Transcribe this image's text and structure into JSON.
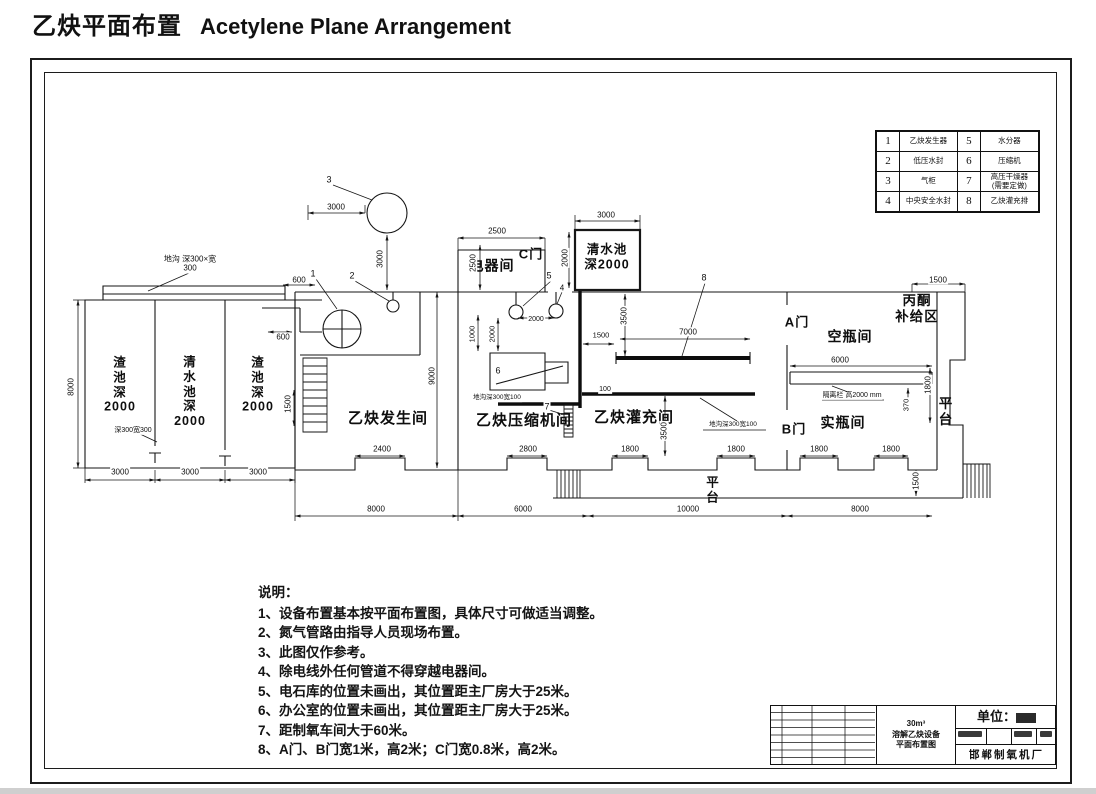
{
  "header": {
    "title_zh": "乙炔平面布置",
    "title_en": "Acetylene Plane Arrangement"
  },
  "legend": {
    "rows": [
      {
        "n1": "1",
        "l1": "乙炔发生器",
        "n2": "5",
        "l2": "水分器"
      },
      {
        "n1": "2",
        "l1": "低压水封",
        "n2": "6",
        "l2": "压缩机"
      },
      {
        "n1": "3",
        "l1": "气柜",
        "n2": "7",
        "l2": "高压干燥器\n(需要定做)"
      },
      {
        "n1": "4",
        "l1": "中央安全水封",
        "n2": "8",
        "l2": "乙炔灌充排"
      }
    ]
  },
  "drawing": {
    "labels": [
      {
        "t": "乙炔发生间",
        "x": 388,
        "y": 419,
        "s": 15,
        "b": 1
      },
      {
        "t": "乙炔压缩机间",
        "x": 524,
        "y": 421,
        "s": 15,
        "b": 1
      },
      {
        "t": "乙炔灌充间",
        "x": 634,
        "y": 418,
        "s": 15,
        "b": 1
      },
      {
        "t": "电器间",
        "x": 492,
        "y": 266,
        "s": 14,
        "b": 1
      },
      {
        "t": "C门",
        "x": 531,
        "y": 254,
        "s": 13,
        "b": 1
      },
      {
        "t": "清水池\n深2000",
        "x": 607,
        "y": 257,
        "s": 12.5,
        "b": 1
      },
      {
        "t": "A门",
        "x": 797,
        "y": 322,
        "s": 13,
        "b": 1
      },
      {
        "t": "B门",
        "x": 794,
        "y": 429,
        "s": 13,
        "b": 1
      },
      {
        "t": "空瓶间",
        "x": 850,
        "y": 337,
        "s": 14,
        "b": 1
      },
      {
        "t": "实瓶间",
        "x": 843,
        "y": 423,
        "s": 14,
        "b": 1
      },
      {
        "t": "丙酮\n补给区",
        "x": 917,
        "y": 309,
        "s": 13.5,
        "b": 1
      },
      {
        "t": "平\n台",
        "x": 946,
        "y": 412,
        "s": 13.5,
        "b": 1
      },
      {
        "t": "平\n台",
        "x": 713,
        "y": 490,
        "s": 12.5,
        "b": 1
      },
      {
        "t": "渣\n池\n深\n2000",
        "x": 120,
        "y": 385,
        "s": 12.5,
        "b": 1
      },
      {
        "t": "清\n水\n池\n深\n2000",
        "x": 190,
        "y": 392,
        "s": 12.5,
        "b": 1
      },
      {
        "t": "渣\n池\n深\n2000",
        "x": 258,
        "y": 385,
        "s": 12.5,
        "b": 1
      },
      {
        "t": "地沟 深300×宽\n300",
        "x": 190,
        "y": 264,
        "s": 8
      },
      {
        "t": "深300宽300",
        "x": 133,
        "y": 431,
        "s": 7
      },
      {
        "t": "3000",
        "x": 336,
        "y": 207,
        "s": 8
      },
      {
        "t": "3000",
        "x": 380,
        "y": 259,
        "s": 8,
        "r": 1
      },
      {
        "t": "600",
        "x": 299,
        "y": 280,
        "s": 8
      },
      {
        "t": "600",
        "x": 283,
        "y": 337,
        "s": 8
      },
      {
        "t": "1500",
        "x": 288,
        "y": 404,
        "s": 8,
        "r": 1
      },
      {
        "t": "8000",
        "x": 71,
        "y": 387,
        "s": 8,
        "r": 1
      },
      {
        "t": "3000",
        "x": 120,
        "y": 472,
        "s": 8
      },
      {
        "t": "3000",
        "x": 190,
        "y": 472,
        "s": 8
      },
      {
        "t": "3000",
        "x": 258,
        "y": 472,
        "s": 8
      },
      {
        "t": "9000",
        "x": 432,
        "y": 376,
        "s": 8,
        "r": 1
      },
      {
        "t": "2500",
        "x": 497,
        "y": 231,
        "s": 8
      },
      {
        "t": "2500",
        "x": 473,
        "y": 263,
        "s": 8,
        "r": 1
      },
      {
        "t": "3000",
        "x": 606,
        "y": 215,
        "s": 8
      },
      {
        "t": "2000",
        "x": 565,
        "y": 258,
        "s": 8,
        "r": 1
      },
      {
        "t": "2000",
        "x": 536,
        "y": 320,
        "s": 7
      },
      {
        "t": "1000",
        "x": 473,
        "y": 334,
        "s": 7.5,
        "r": 1
      },
      {
        "t": "2000",
        "x": 493,
        "y": 334,
        "s": 7.5,
        "r": 1
      },
      {
        "t": "地沟深300宽100",
        "x": 497,
        "y": 398,
        "s": 6.5
      },
      {
        "t": "1500",
        "x": 601,
        "y": 336,
        "s": 7.5
      },
      {
        "t": "100",
        "x": 605,
        "y": 390,
        "s": 7
      },
      {
        "t": "3500",
        "x": 624,
        "y": 316,
        "s": 8,
        "r": 1
      },
      {
        "t": "7000",
        "x": 688,
        "y": 332,
        "s": 8
      },
      {
        "t": "3500",
        "x": 664,
        "y": 431,
        "s": 8,
        "r": 1
      },
      {
        "t": "地沟深300宽100",
        "x": 733,
        "y": 425,
        "s": 6.5
      },
      {
        "t": "2400",
        "x": 382,
        "y": 449,
        "s": 8
      },
      {
        "t": "2800",
        "x": 528,
        "y": 449,
        "s": 8
      },
      {
        "t": "1800",
        "x": 630,
        "y": 449,
        "s": 8
      },
      {
        "t": "1800",
        "x": 736,
        "y": 449,
        "s": 8
      },
      {
        "t": "1800",
        "x": 819,
        "y": 449,
        "s": 8
      },
      {
        "t": "1800",
        "x": 891,
        "y": 449,
        "s": 8
      },
      {
        "t": "8000",
        "x": 376,
        "y": 509,
        "s": 8
      },
      {
        "t": "6000",
        "x": 523,
        "y": 509,
        "s": 8
      },
      {
        "t": "10000",
        "x": 688,
        "y": 509,
        "s": 8
      },
      {
        "t": "8000",
        "x": 860,
        "y": 509,
        "s": 8
      },
      {
        "t": "1500",
        "x": 916,
        "y": 481,
        "s": 8,
        "r": 1
      },
      {
        "t": "6000",
        "x": 840,
        "y": 360,
        "s": 8
      },
      {
        "t": "隔离栏 高2000 mm",
        "x": 852,
        "y": 396,
        "s": 7
      },
      {
        "t": "370",
        "x": 907,
        "y": 405,
        "s": 7.5,
        "r": 1
      },
      {
        "t": "1800",
        "x": 928,
        "y": 385,
        "s": 8,
        "r": 1
      },
      {
        "t": "1500",
        "x": 938,
        "y": 280,
        "s": 8
      },
      {
        "t": "1",
        "x": 313,
        "y": 274,
        "s": 9
      },
      {
        "t": "2",
        "x": 352,
        "y": 276,
        "s": 9
      },
      {
        "t": "3",
        "x": 329,
        "y": 180,
        "s": 9
      },
      {
        "t": "4",
        "x": 562,
        "y": 288,
        "s": 8
      },
      {
        "t": "5",
        "x": 549,
        "y": 276,
        "s": 9
      },
      {
        "t": "6",
        "x": 498,
        "y": 371,
        "s": 9
      },
      {
        "t": "7",
        "x": 547,
        "y": 407,
        "s": 9
      },
      {
        "t": "8",
        "x": 704,
        "y": 278,
        "s": 9
      }
    ]
  },
  "notes": {
    "heading": "说明：",
    "items": [
      "1、设备布置基本按平面布置图，具体尺寸可做适当调整。",
      "2、氮气管路由指导人员现场布置。",
      "3、此图仅作参考。",
      "4、除电线外任何管道不得穿越电器间。",
      "5、电石库的位置未画出，其位置距主厂房大于25米。",
      "6、办公室的位置未画出，其位置距主厂房大于25米。",
      "7、距制氧车间大于60米。",
      "8、A门、B门宽1米，高2米；C门宽0.8米，高2米。"
    ]
  },
  "title_block": {
    "drawing_title_line1": "30m³",
    "drawing_title_line2": "溶解乙炔设备",
    "drawing_title_line3": "平面布置图",
    "unit_label": "单位：",
    "unit_value": "mm",
    "company": "邯郸制氧机厂"
  }
}
